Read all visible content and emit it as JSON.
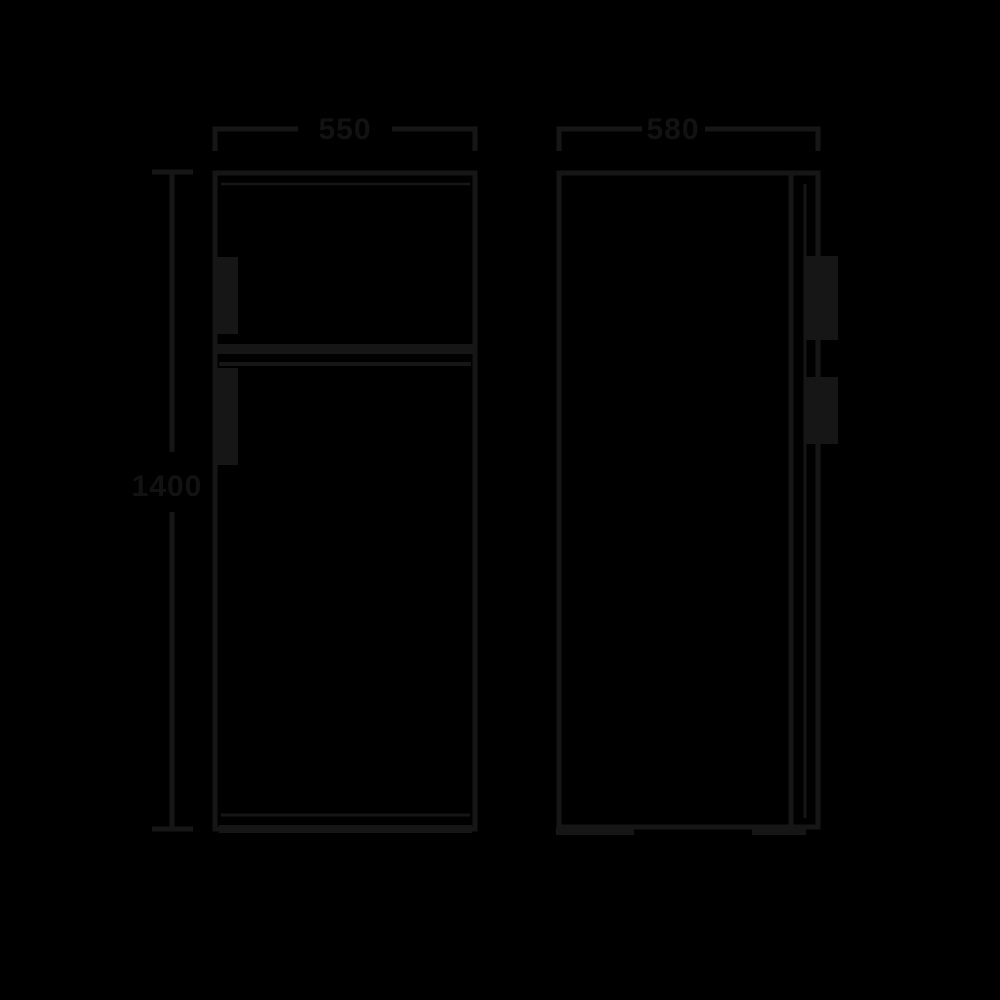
{
  "diagram": {
    "title": "refrigerator-dimension-drawing",
    "description": "Technical line drawing of a top-freezer refrigerator: front elevation (left) and side elevation (right) with dimension lines",
    "colors": {
      "background": "#000000",
      "line": "#161616",
      "text": "#121212"
    },
    "dimensions": {
      "width": {
        "value": "550",
        "position": "top-left-horizontal"
      },
      "depth": {
        "value": "580",
        "position": "top-right-horizontal"
      },
      "height": {
        "value": "1400",
        "position": "left-vertical"
      }
    },
    "views": {
      "front": {
        "name": "front-view",
        "features": [
          "freezer-compartment-door",
          "fridge-door",
          "freezer-divider",
          "freezer-handle",
          "fridge-handle",
          "base-plinth"
        ]
      },
      "side": {
        "name": "side-view",
        "features": [
          "cabinet-body",
          "door-slab",
          "freezer-handle",
          "fridge-handle",
          "feet"
        ]
      }
    }
  }
}
